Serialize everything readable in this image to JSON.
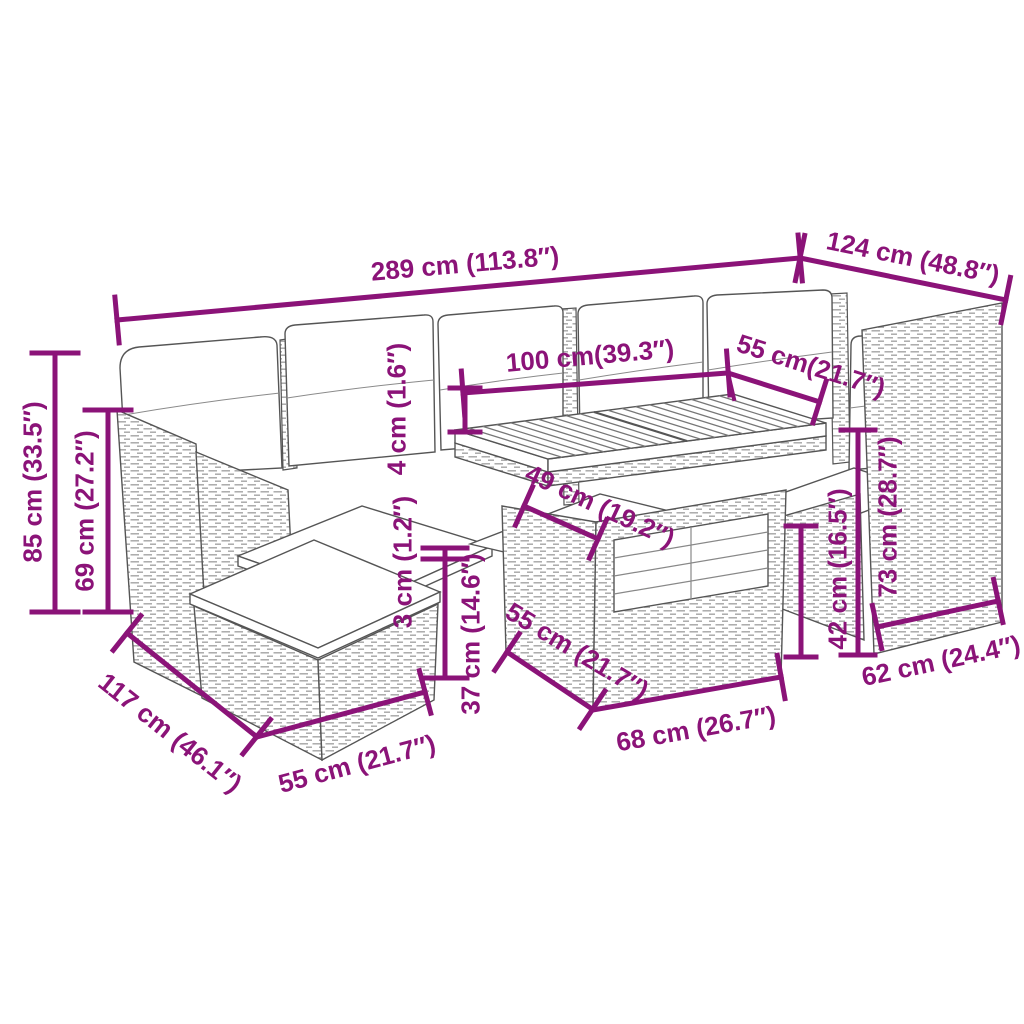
{
  "diagram": {
    "type": "product-dimension-diagram",
    "subject": "poly-rattan garden lounge set with table, ottoman and cushions",
    "accent_color": "#8B1378",
    "art_line_color": "#555555",
    "background_color": "#FFFFFF",
    "units": "cm (inches)",
    "dimensions": [
      {
        "id": "overall-width",
        "label": "289 cm (113.8″)"
      },
      {
        "id": "right-section-depth",
        "label": "124 cm (48.8″)"
      },
      {
        "id": "total-height",
        "label": "85 cm (33.5″)"
      },
      {
        "id": "backrest-height",
        "label": "69 cm (27.2″)"
      },
      {
        "id": "table-top-length",
        "label": "100 cm(39.3″)"
      },
      {
        "id": "table-top-depth",
        "label": "55 cm(21.7″)"
      },
      {
        "id": "table-top-thickness",
        "label": "4 cm (1.6″)"
      },
      {
        "id": "shelf-depth",
        "label": "49 cm (19.2″)"
      },
      {
        "id": "seat-cushion-thickness",
        "label": "3 cm (1.2″)"
      },
      {
        "id": "seat-height",
        "label": "37 cm (14.6″)"
      },
      {
        "id": "table-base-depth",
        "label": "55 cm (21.7″)"
      },
      {
        "id": "table-base-width",
        "label": "68 cm (26.7″)"
      },
      {
        "id": "armchair-seat-height",
        "label": "42 cm (16.5″)"
      },
      {
        "id": "table-height",
        "label": "73 cm (28.7″)"
      },
      {
        "id": "right-base-width",
        "label": "62 cm (24.4″)"
      },
      {
        "id": "left-section-depth",
        "label": "117 cm (46.1″)"
      },
      {
        "id": "ottoman-width",
        "label": "55 cm (21.7″)"
      }
    ]
  }
}
